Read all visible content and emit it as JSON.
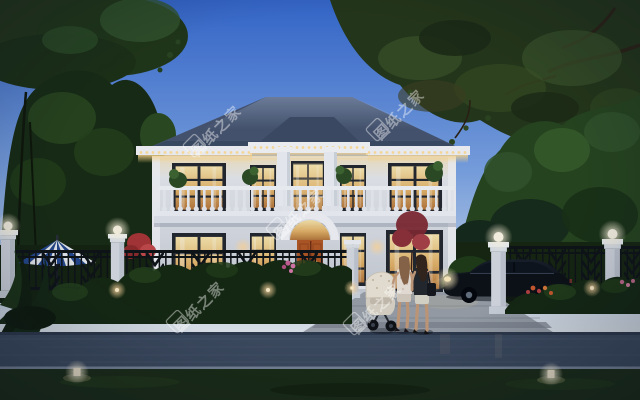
{
  "watermark": {
    "text": "图纸之家",
    "color": "#ffffff"
  },
  "palette": {
    "sky_top": "#3568cd",
    "sky_mid": "#7ba3e2",
    "sky_horizon": "#e8ebec",
    "roof": "#46546e",
    "wall": "#e9ebee",
    "door": "#b25722",
    "window_glow_top": "#f8e5ac",
    "window_glow_bottom": "#b5763a",
    "eave_light": "#ffd98c",
    "canopy": "#243618",
    "foliage_dark": "#182b12",
    "foliage_mid": "#26451d",
    "shrub": "#152810",
    "fence": "#0e1216",
    "driveway": "#99a0a8",
    "road": "#3d4a5e",
    "grass": "#1b2c13",
    "car_body": "#0c1015",
    "umbrella_blue": "#24488f",
    "umbrella_white": "#e9edf2"
  }
}
